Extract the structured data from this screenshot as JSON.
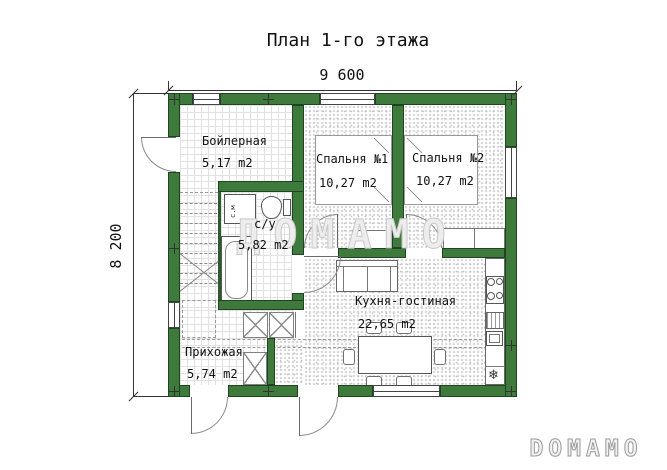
{
  "title": "План 1-го этажа",
  "dimensions": {
    "width": "9 600",
    "height": "8 200"
  },
  "rooms": {
    "boiler": {
      "name": "Бойлерная",
      "area": "5,17 m2"
    },
    "bedroom1": {
      "name": "Спальня №1",
      "area": "10,27 m2"
    },
    "bedroom2": {
      "name": "Спальня №2",
      "area": "10,27 m2"
    },
    "bathroom": {
      "name": "с/у",
      "area": "5,82 m2"
    },
    "kitchen_living": {
      "name": "Кухня-гостиная",
      "area": "22,65 m2"
    },
    "hallway": {
      "name": "Прихожая",
      "area": "5,74 m2"
    }
  },
  "fixtures": {
    "washing_machine": "с.м",
    "fridge_symbol": "❄"
  },
  "watermark": "ДОМАМО",
  "logo": "DOMAMO",
  "colors": {
    "wall": "#3d7a3b",
    "line": "#333333",
    "watermark": "#cccccc"
  }
}
